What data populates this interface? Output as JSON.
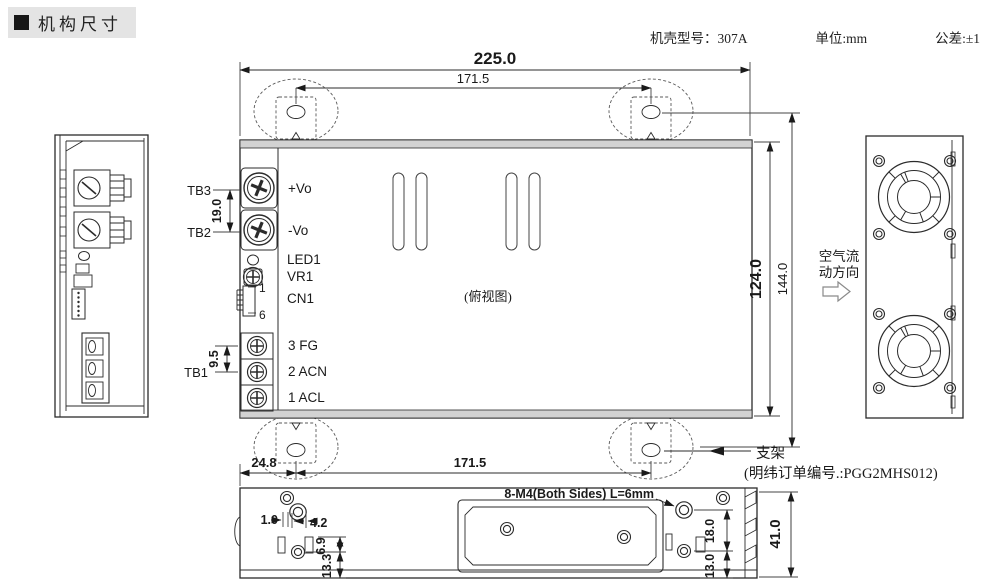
{
  "header": {
    "title": "机构尺寸",
    "model": "机壳型号：307A",
    "unit": "单位:mm",
    "tolerance": "公差:±1"
  },
  "top_view": {
    "caption": "(俯视图)",
    "dim_width": "225.0",
    "dim_hole_span": "171.5",
    "dim_height": "124.0",
    "dim_total_height": "144.0",
    "dim_tb_pitch": "19.0",
    "dim_tb1_pitch": "9.5",
    "label_tb3": "TB3",
    "label_tb2": "TB2",
    "label_tb1": "TB1",
    "label_vo_plus": "+Vo",
    "label_vo_minus": "-Vo",
    "label_led1": "LED1",
    "label_vr1": "VR1",
    "label_cn1": "CN1",
    "pin_top": "1",
    "pin_bottom": "6",
    "label_fg": "3 FG",
    "label_acn": "2 ACN",
    "label_acl": "1 ACL"
  },
  "airflow": {
    "line1": "空气流",
    "line2": "动方向"
  },
  "bracket_note": {
    "name": "支架",
    "order": "(明纬订单编号.:PGG2MHS012)"
  },
  "bottom_view": {
    "dim_edge": "24.8",
    "dim_span": "171.5",
    "dim_a": "1.0",
    "dim_b": "4.2",
    "dim_c": "6.9",
    "dim_d": "13.3",
    "dim_e": "18.0",
    "dim_f": "13.0",
    "dim_height": "41.0",
    "screw_note": "8-M4(Both Sides) L=6mm"
  },
  "colors": {
    "teal": "#2F9EAE",
    "light_blue": "#A6D6DF"
  }
}
